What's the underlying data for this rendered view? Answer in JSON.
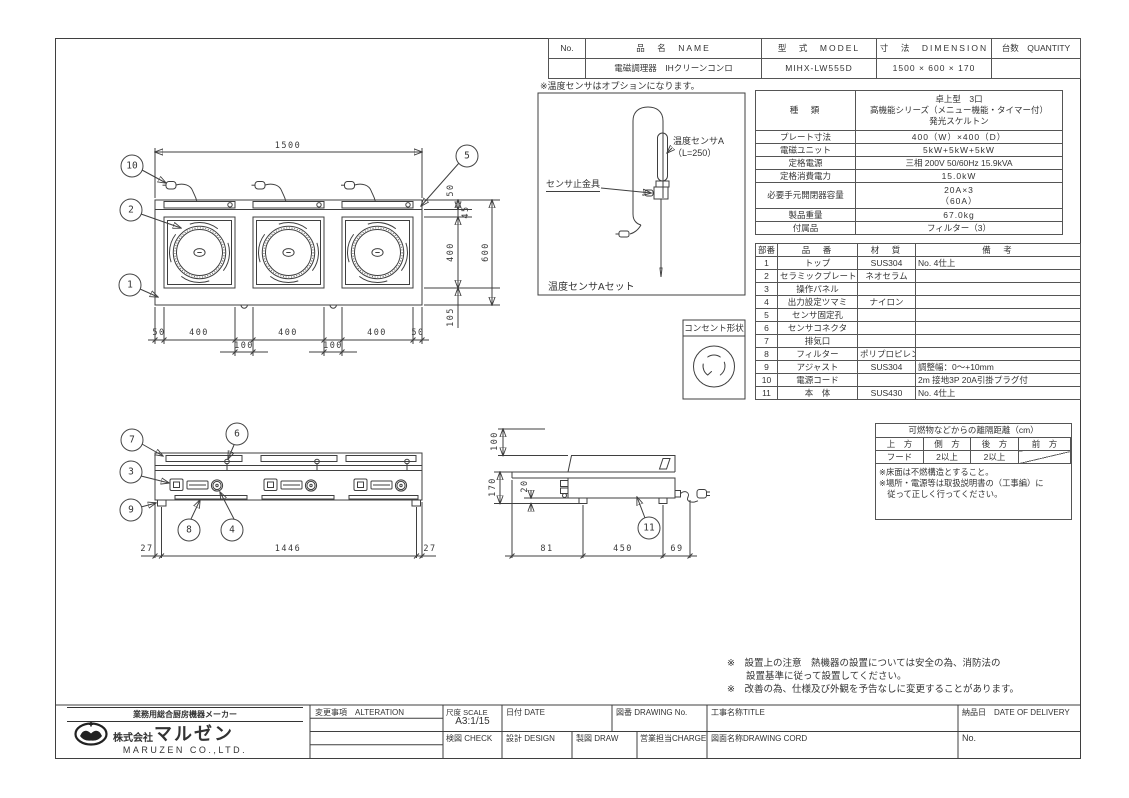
{
  "header_table": {
    "headers": [
      "No.",
      "品　名　NAME",
      "型　式　MODEL",
      "寸　法　DIMENSION",
      "台数　QUANTITY"
    ],
    "row": {
      "no": "",
      "name": "電磁調理器　IHクリーンコンロ",
      "model": "MIHX-LW555D",
      "dimension": "1500 × 600 × 170",
      "quantity": ""
    }
  },
  "sensor_panel": {
    "note": "※温度センサはオプションになります。",
    "label_probe": "温度センサA",
    "label_probe2": "（L=250）",
    "label_clamp": "センサ止金具",
    "caption": "温度センサAセット"
  },
  "outlet": {
    "title": "コンセント形状"
  },
  "spec_table": {
    "rows": [
      {
        "label": "種　類",
        "value": "卓上型　3口\n高機能シリーズ（メニュー機能・タイマー付）\n発光スケルトン"
      },
      {
        "label": "プレート寸法",
        "value": "400（W）×400（D）"
      },
      {
        "label": "電磁ユニット",
        "value": "5kW+5kW+5kW"
      },
      {
        "label": "定格電源",
        "value": "三相 200V 50/60Hz 15.9kVA"
      },
      {
        "label": "定格消費電力",
        "value": "15.0kW"
      },
      {
        "label": "必要手元開閉器容量",
        "value": "20A×3\n（60A）"
      },
      {
        "label": "製品重量",
        "value": "67.0kg"
      },
      {
        "label": "付属品",
        "value": "フィルター（3）"
      }
    ]
  },
  "parts_table": {
    "headers": [
      "部番",
      "品　番",
      "材　質",
      "備　考"
    ],
    "rows": [
      [
        "1",
        "トップ",
        "SUS304",
        "No. 4仕上"
      ],
      [
        "2",
        "セラミックプレート",
        "ネオセラム",
        ""
      ],
      [
        "3",
        "操作パネル",
        "",
        ""
      ],
      [
        "4",
        "出力設定ツマミ",
        "ナイロン",
        ""
      ],
      [
        "5",
        "センサ固定孔",
        "",
        ""
      ],
      [
        "6",
        "センサコネクタ",
        "",
        ""
      ],
      [
        "7",
        "排気口",
        "",
        ""
      ],
      [
        "8",
        "フィルター",
        "ポリプロピレン",
        ""
      ],
      [
        "9",
        "アジャスト",
        "SUS304",
        "調整幅：0～+10mm"
      ],
      [
        "10",
        "電源コード",
        "",
        "2m 接地3P 20A引掛プラグ付"
      ],
      [
        "11",
        "本　体",
        "SUS430",
        "No. 4仕上"
      ]
    ]
  },
  "clearance_table": {
    "title": "可燃物などからの離隔距離（cm）",
    "headers": [
      "上　方",
      "側　方",
      "後　方",
      "前　方"
    ],
    "row": [
      "フード",
      "2以上",
      "2以上",
      ""
    ],
    "notes": "※床面は不燃構造とすること。\n※場所・電源等は取扱説明書の（工事編）に\n　従って正しく行ってください。"
  },
  "bottom_notes": {
    "line1": "※　設置上の注意　熱機器の設置については安全の為、消防法の",
    "line2": "　　設置基準に従って設置してください。",
    "line3": "※　改善の為、仕様及び外観を予告なしに変更することがあります。"
  },
  "title_block": {
    "maker_tagline": "業務用総合厨房機器メーカー",
    "company_prefix": "株式会社",
    "company_logotype": "マルゼン",
    "company_en": "MARUZEN CO.,LTD.",
    "alteration_label": "変更事項　ALTERATION",
    "scale_label": "尺度 SCALE",
    "scale_value": "A3:1/15",
    "date_label": "日付 DATE",
    "drawing_no_label": "図番 DRAWING No.",
    "title_label": "工事名称TITLE",
    "delivery_label": "納品日　DATE OF DELIVERY",
    "check_label": "検図 CHECK",
    "design_label": "設計 DESIGN",
    "draw_label": "製図 DRAW",
    "charge_label": "営業担当CHARGE",
    "drawing_cord_label": "図面名称DRAWING CORD",
    "no_label": "No."
  },
  "drawing": {
    "balloons": {
      "n1": "1",
      "n2": "2",
      "n3": "3",
      "n4": "4",
      "n5": "5",
      "n6": "6",
      "n7": "7",
      "n8": "8",
      "n9": "9",
      "n10": "10",
      "n11": "11"
    },
    "dims": {
      "plan_width": "1500",
      "plan_right": [
        "50",
        "45",
        "400",
        "600",
        "105"
      ],
      "plan_bottom": [
        "50",
        "400",
        "400",
        "400",
        "50"
      ],
      "plan_gaps": [
        "100",
        "100"
      ],
      "front_bottom": [
        "27",
        "1446",
        "27"
      ],
      "side_left": [
        "100",
        "170",
        "20"
      ],
      "side_bottom": [
        "81",
        "450",
        "69"
      ]
    }
  }
}
